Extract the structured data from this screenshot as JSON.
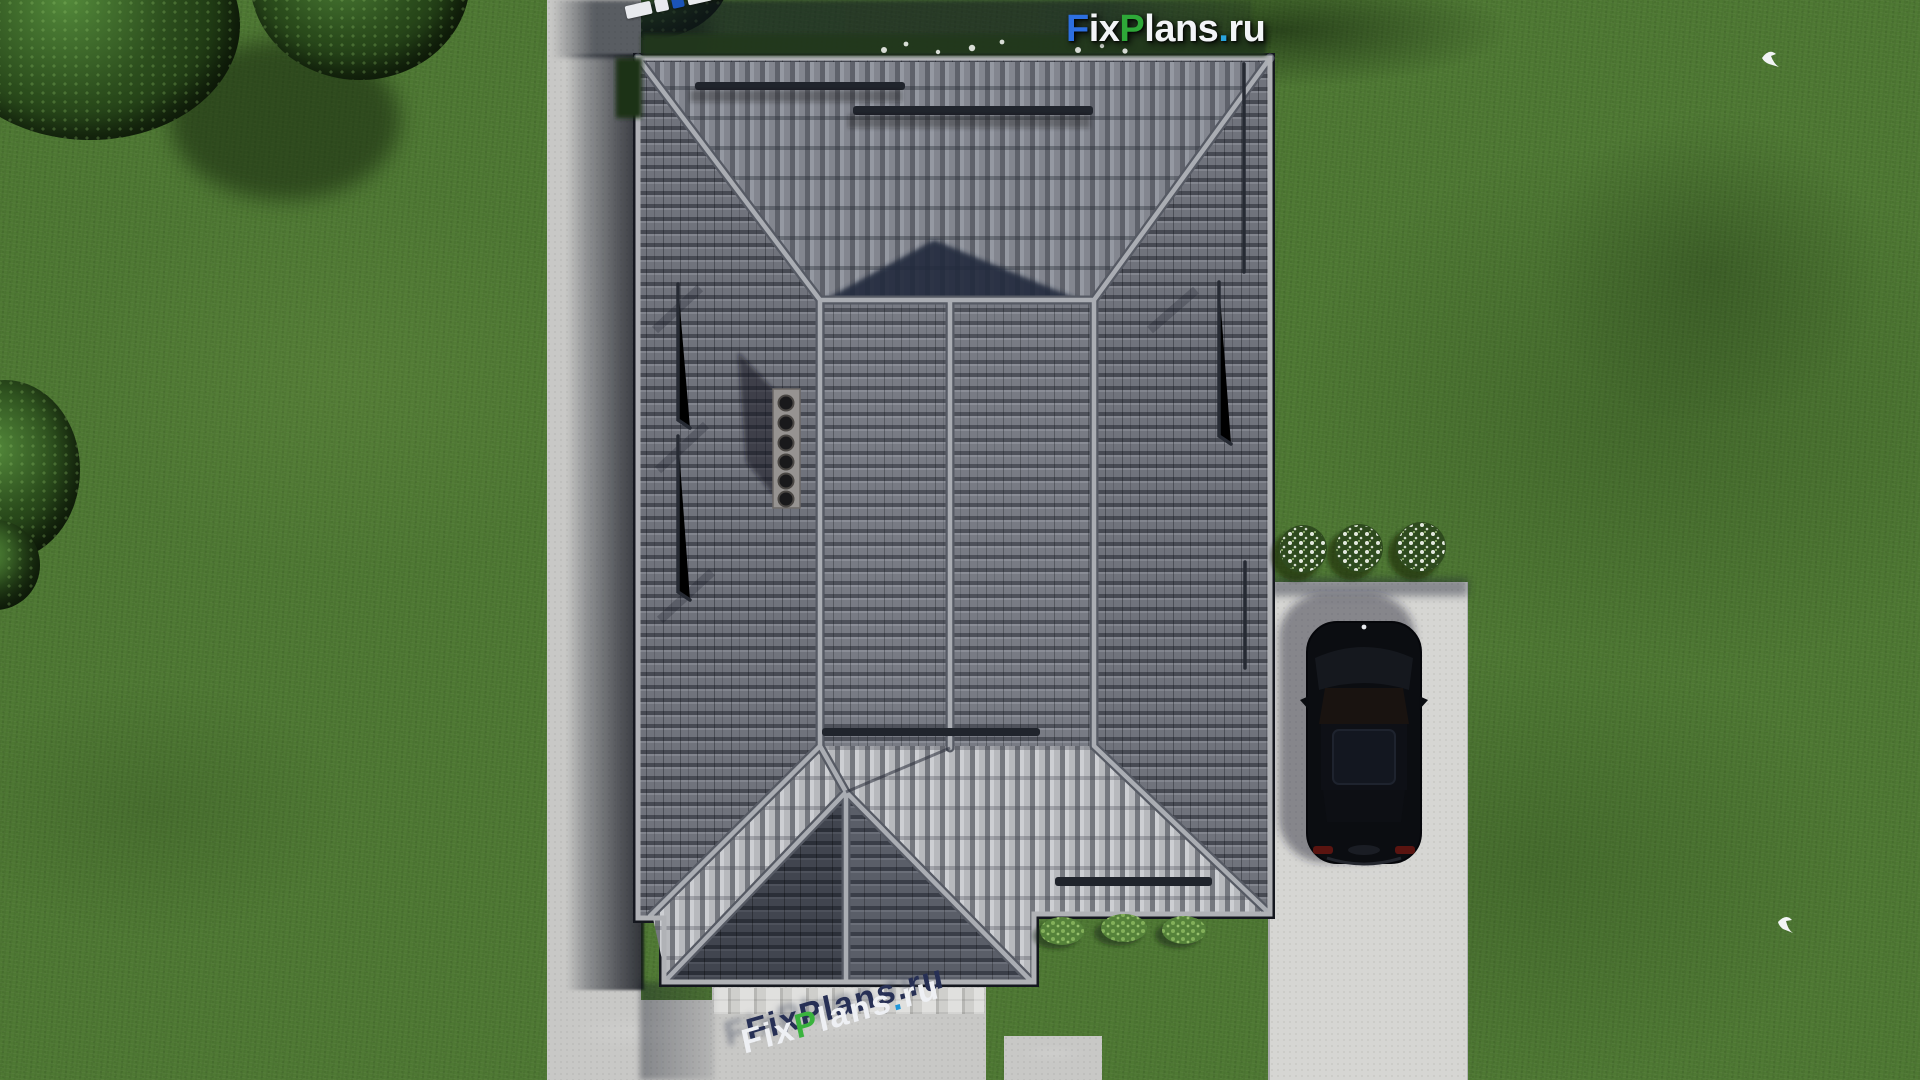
{
  "brand": {
    "site_name": "FixPlans.ru",
    "logo_segments": [
      {
        "text": "F",
        "color": "#2d6fe0"
      },
      {
        "text": "ix",
        "color": "#f2f4f7"
      },
      {
        "text": "P",
        "color": "#2ea838"
      },
      {
        "text": "lans",
        "color": "#f2f4f7"
      },
      {
        "text": ".",
        "color": "#2aa4dc"
      },
      {
        "text": "ru",
        "color": "#f2f4f7"
      }
    ],
    "watermark_bottom": {
      "text": "FixPlans.ru",
      "extrusion_color": "#273055",
      "cast_shadow_color": "rgba(72,79,99,0.50)",
      "segments": [
        {
          "text": "F",
          "color": "#eef0f4"
        },
        {
          "text": "ix",
          "color": "#eef0f4"
        },
        {
          "text": "P",
          "color": "#3ab33e"
        },
        {
          "text": "lans",
          "color": "#eef0f4"
        },
        {
          "text": ".",
          "color": "#2196d8"
        },
        {
          "text": "ru",
          "color": "#eef0f4"
        }
      ]
    },
    "watermark_topleft_blocks": [
      "#e8eaee",
      "#e8eaee",
      "#1b54b8",
      "#e8eaee",
      "#e8eaee",
      "#e8eaee",
      "#e8eaee",
      "#2ea838",
      "#e8eaee",
      "#2ea838",
      "#1b54b8"
    ]
  },
  "scene": {
    "view": "top-down aerial render of single-family house",
    "objects": [
      "hip-roof-house",
      "chimney-with-6-vents",
      "black-sedan-car",
      "left-sidewalk",
      "entrance-walkway",
      "driveway",
      "white-flower-bushes",
      "green-bushes",
      "trees",
      "two-white-birds"
    ],
    "palette": {
      "grass": "#4e7833",
      "grass_shadow": "#24321c",
      "roof_tile": "#70737c",
      "roof_tile_dark": "#474a53",
      "roof_tile_bright": "#b7b9bd",
      "ridge_cap": "#aaadb3",
      "roof_shadow_triangle": "#222b3e",
      "concrete_path": "#c8c8c6",
      "driveway": "#d6d6d3",
      "car_body": "#0b0d11",
      "cast_shadow": "#141a28"
    }
  }
}
